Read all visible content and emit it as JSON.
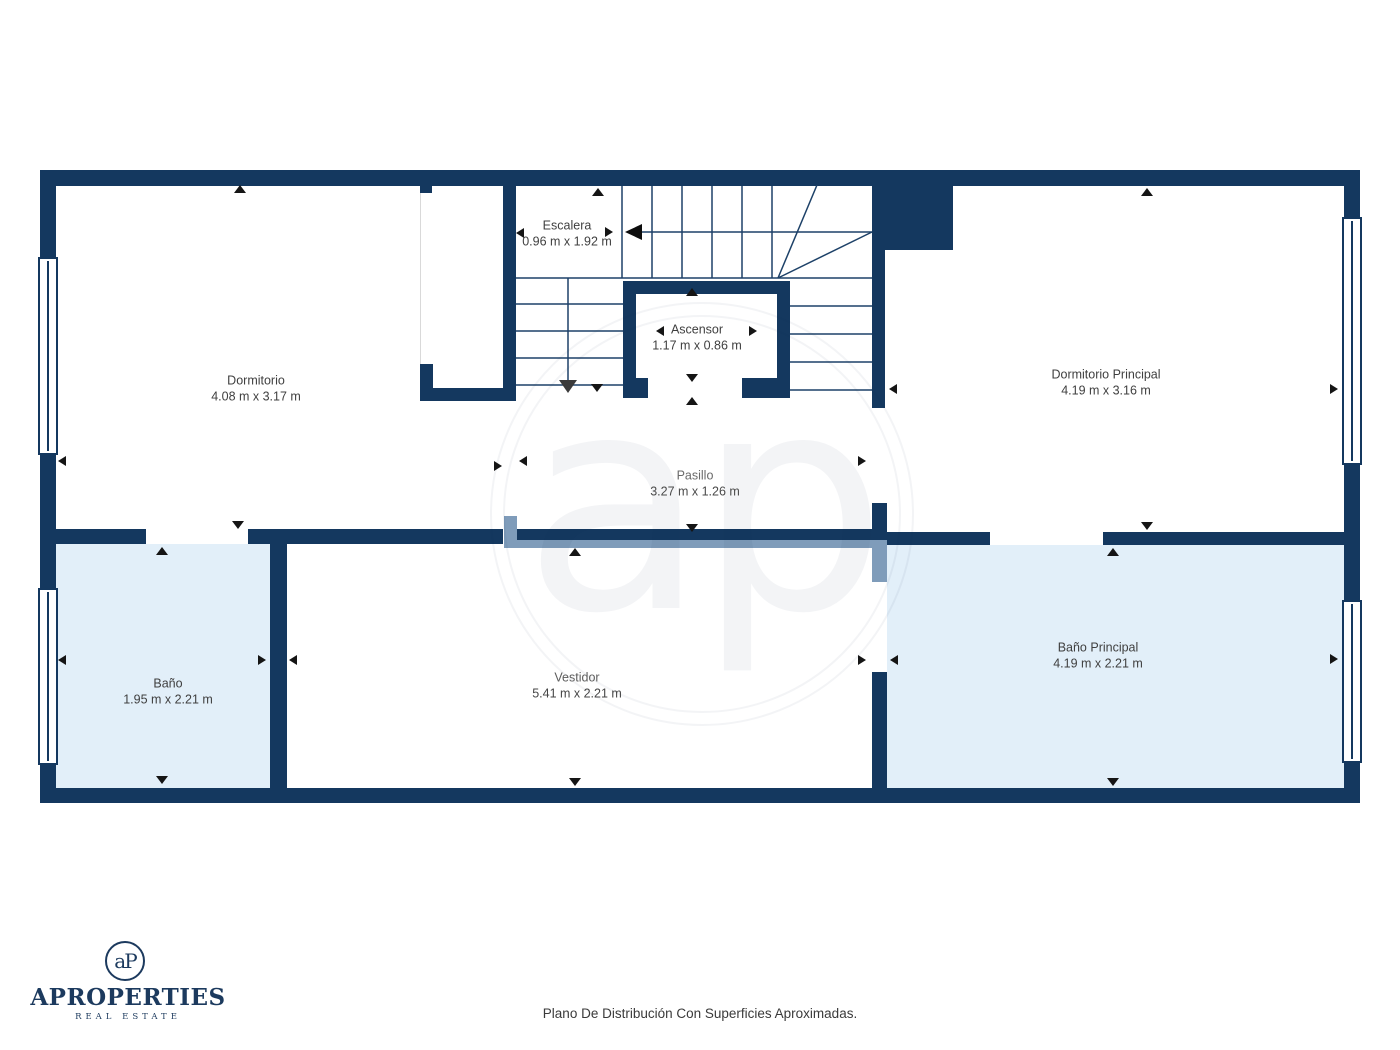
{
  "rooms": {
    "dormitorio": {
      "name": "Dormitorio",
      "dims": "4.08 m x 3.17 m"
    },
    "escalera": {
      "name": "Escalera",
      "dims": "0.96 m x 1.92 m"
    },
    "ascensor": {
      "name": "Ascensor",
      "dims": "1.17 m x 0.86 m"
    },
    "dormitorio_principal": {
      "name": "Dormitorio Principal",
      "dims": "4.19 m x 3.16 m"
    },
    "pasillo": {
      "name": "Pasillo",
      "dims": "3.27 m x 1.26 m"
    },
    "bano": {
      "name": "Baño",
      "dims": "1.95 m x 2.21 m"
    },
    "vestidor": {
      "name": "Vestidor",
      "dims": "5.41 m x 2.21 m"
    },
    "bano_principal": {
      "name": "Baño Principal",
      "dims": "4.19 m x 2.21 m"
    }
  },
  "watermark": {
    "monogram": "ap"
  },
  "branding": {
    "monogram": "aP",
    "brand": "APROPERTIES",
    "tagline": "REAL ESTATE"
  },
  "footer": {
    "caption": "Plano De Distribución Con Superficies Aproximadas."
  },
  "colors": {
    "wall": "#14385f",
    "room_fill": "#e2eff9",
    "door_panel": "#7f9cba"
  }
}
